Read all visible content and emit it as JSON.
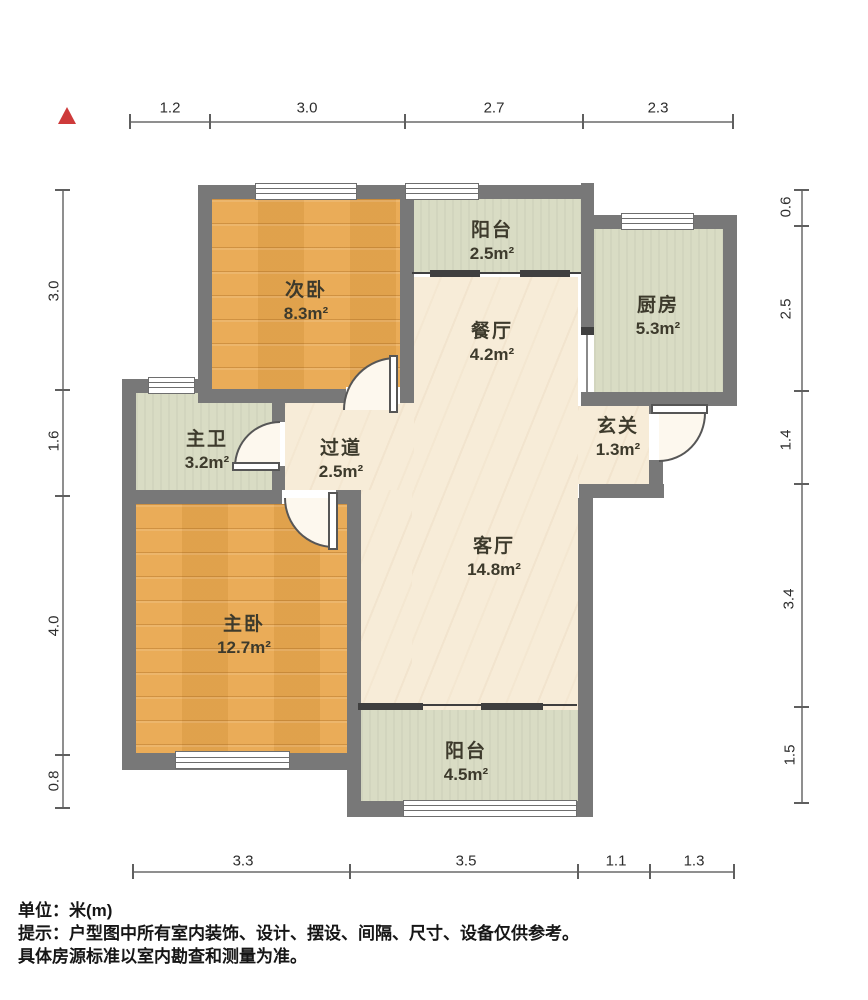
{
  "plan": {
    "rooms": {
      "bedroom_second": {
        "name": "次卧",
        "area": "8.3m²"
      },
      "balcony_north": {
        "name": "阳台",
        "area": "2.5m²"
      },
      "kitchen": {
        "name": "厨房",
        "area": "5.3m²"
      },
      "dining": {
        "name": "餐厅",
        "area": "4.2m²"
      },
      "bath_master": {
        "name": "主卫",
        "area": "3.2m²"
      },
      "hallway": {
        "name": "过道",
        "area": "2.5m²"
      },
      "foyer": {
        "name": "玄关",
        "area": "1.3m²"
      },
      "living": {
        "name": "客厅",
        "area": "14.8m²"
      },
      "bedroom_master": {
        "name": "主卧",
        "area": "12.7m²"
      },
      "balcony_south": {
        "name": "阳台",
        "area": "4.5m²"
      }
    },
    "dims": {
      "top": [
        "1.2",
        "3.0",
        "2.7",
        "2.3"
      ],
      "bottom": [
        "3.3",
        "3.5",
        "1.1",
        "1.3"
      ],
      "left": [
        "3.0",
        "1.6",
        "4.0",
        "0.8"
      ],
      "right": [
        "0.6",
        "2.5",
        "1.4",
        "3.4",
        "1.5"
      ]
    },
    "icons": {
      "north_indicator": "red-triangle-up"
    },
    "colors": {
      "wood_floor": "#e9a84f",
      "tile_floor": "#d9dcc4",
      "main_floor": "#f7ecd8",
      "wall": "#787878",
      "north_red": "#ce3a3a"
    },
    "footer": {
      "unit_line": "单位：米(m)",
      "tip_line1": "提示：户型图中所有室内装饰、设计、摆设、间隔、尺寸、设备仅供参考。",
      "tip_line2": "具体房源标准以室内勘查和测量为准。"
    }
  }
}
